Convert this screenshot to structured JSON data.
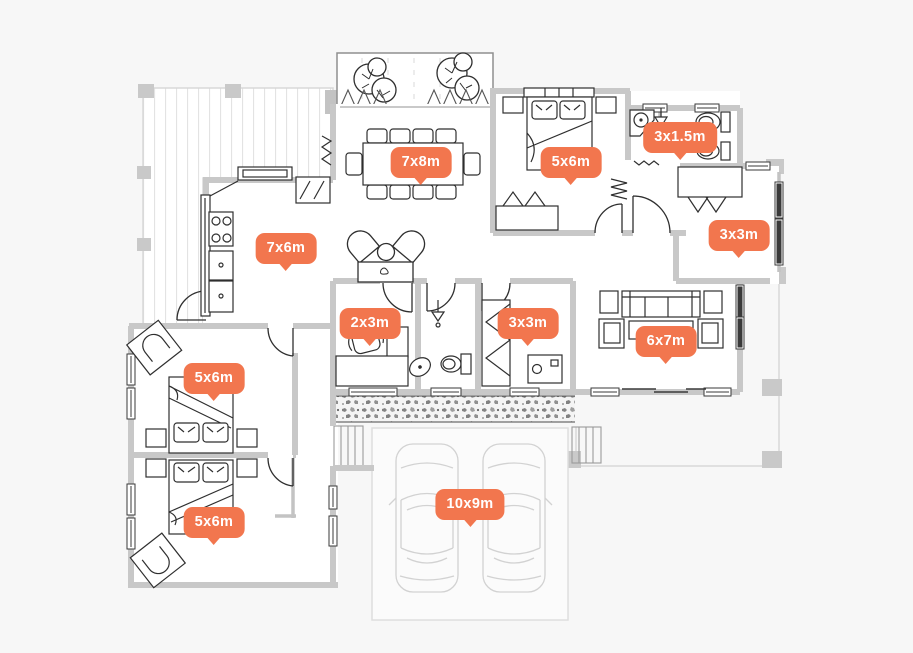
{
  "canvas": {
    "width": 913,
    "height": 653
  },
  "palette": {
    "background": "#f7f7f7",
    "badge": "#f2764e",
    "badge_text": "#ffffff",
    "wall": "#c8c8c8",
    "fixture": "#3a3a3a",
    "faint": "#d9d9d9"
  },
  "floor_plan": {
    "type": "house-floor-plan",
    "badges": [
      {
        "id": "dining",
        "room": "dining-area",
        "label": "7x8m"
      },
      {
        "id": "bedroom-top",
        "room": "bedroom",
        "label": "5x6m"
      },
      {
        "id": "bathroom-top",
        "room": "bathroom",
        "label": "3x1.5m"
      },
      {
        "id": "dressing-right",
        "room": "dressing-room",
        "label": "3x3m"
      },
      {
        "id": "kitchen",
        "room": "kitchen",
        "label": "7x6m"
      },
      {
        "id": "office",
        "room": "home-office",
        "label": "2x3m"
      },
      {
        "id": "laundry",
        "room": "laundry",
        "label": "3x3m"
      },
      {
        "id": "living",
        "room": "living-room",
        "label": "6x7m"
      },
      {
        "id": "bedroom-left-1",
        "room": "bedroom",
        "label": "5x6m"
      },
      {
        "id": "bedroom-left-2",
        "room": "bedroom",
        "label": "5x6m"
      },
      {
        "id": "garage",
        "room": "garage",
        "label": "10x9m"
      }
    ]
  }
}
